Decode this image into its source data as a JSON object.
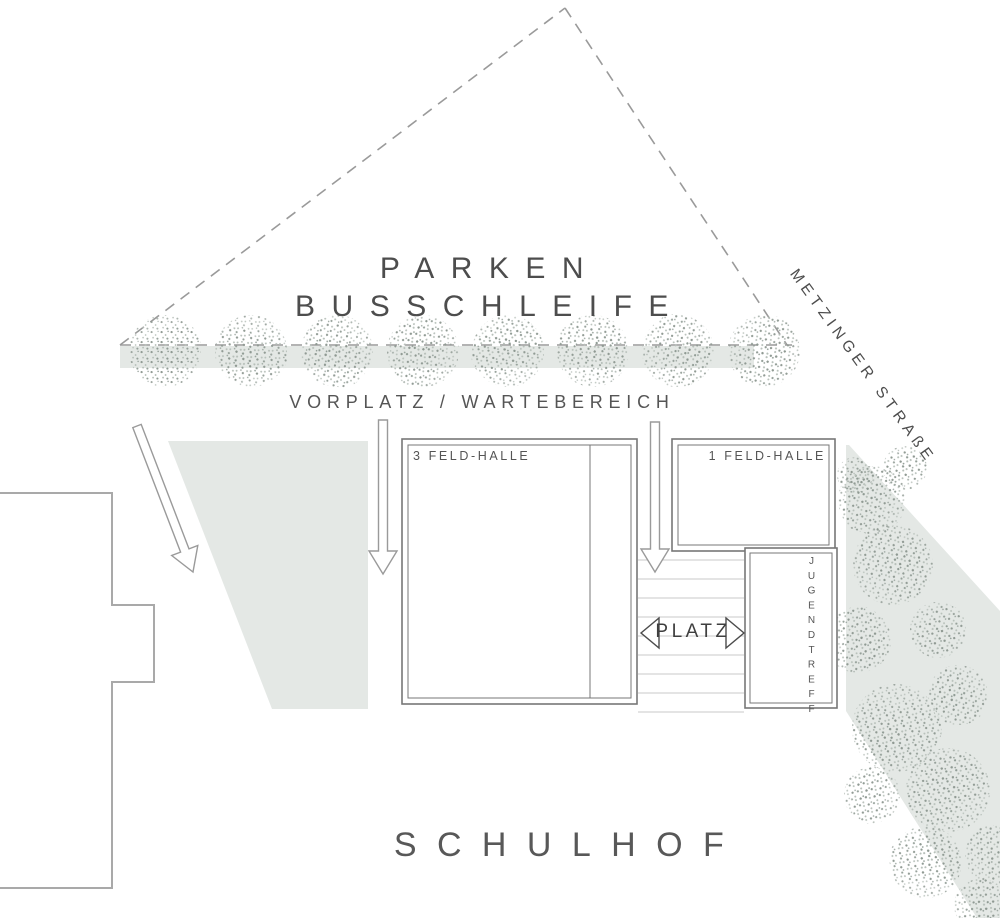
{
  "labels": {
    "parken": "PARKEN",
    "busschleife": "BUSSCHLEIFE",
    "vorplatz": "VORPLATZ / WARTEBEREICH",
    "strasse": "METZINGER STRAßE",
    "hall3": "3 FELD-HALLE",
    "hall1": "1 FELD-HALLE",
    "platz": "PLATZ",
    "jugendtreff": "JUGENDTREFF",
    "schulhof": "SCHULHOF"
  },
  "colors": {
    "surface": "#e4e8e5",
    "dash": "#9a9a9a",
    "line_dark": "#777777",
    "line_light": "#a9a9a9",
    "stair": "#c8c8c8",
    "text": "#4d4d4d",
    "tree_dot_dark": "#8e9992",
    "tree_dot_light": "#b7c0ba"
  },
  "trees": {
    "row": {
      "y": 351,
      "r": 36,
      "xs": [
        165,
        251,
        337,
        423,
        508,
        593,
        678,
        764
      ]
    },
    "scatter": [
      [
        872,
        500,
        34
      ],
      [
        905,
        468,
        22
      ],
      [
        893,
        565,
        40
      ],
      [
        858,
        640,
        33
      ],
      [
        938,
        630,
        28
      ],
      [
        896,
        728,
        44
      ],
      [
        958,
        695,
        30
      ],
      [
        872,
        795,
        28
      ],
      [
        948,
        790,
        42
      ],
      [
        926,
        862,
        36
      ],
      [
        995,
        855,
        30
      ],
      [
        980,
        905,
        26
      ],
      [
        855,
        475,
        18
      ]
    ]
  },
  "arrows": [
    [
      137,
      426,
      193,
      572
    ],
    [
      383,
      420,
      383,
      574
    ],
    [
      655,
      422,
      655,
      572
    ]
  ],
  "stairs": {
    "x1": 638,
    "x2": 744,
    "y_start": 560,
    "y_end": 712,
    "step": 19
  }
}
